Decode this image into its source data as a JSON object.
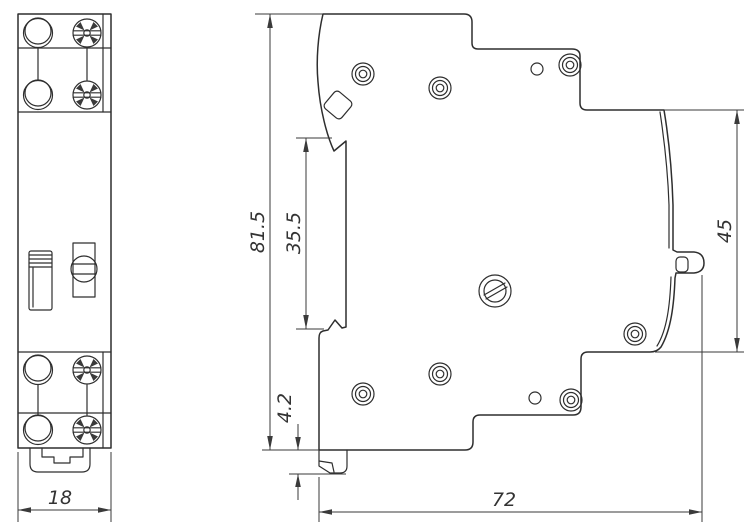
{
  "drawing": {
    "type": "technical-drawing",
    "views": {
      "front": {
        "width_mm": "18"
      },
      "side": {
        "overall_height_mm": "81.5",
        "recess_height_mm": "35.5",
        "rail_face_height_mm": "45",
        "foot_height_mm": "4.2",
        "overall_depth_mm": "72"
      }
    },
    "icons": {
      "terminal_hole": "plain-circle-terminal",
      "pozidriv_screw": "cross-recess-screw-head",
      "rivet": "concentric-circle-rivet",
      "toggle": "toggle-switch-slider",
      "selector": "slotted-selector-screw",
      "din_foot": "din-rail-mounting-foot"
    },
    "colors": {
      "line": "#2e2e2e",
      "dimension": "#3a3a3a",
      "background": "#ffffff"
    }
  }
}
